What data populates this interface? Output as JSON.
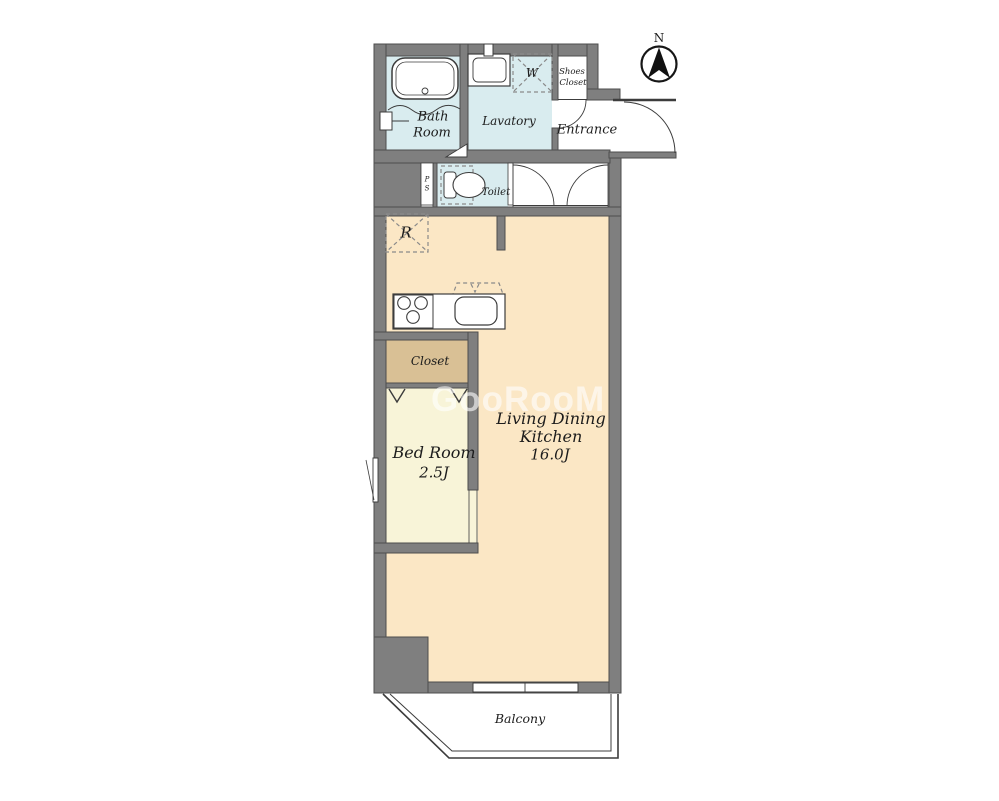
{
  "compass": {
    "label": "N"
  },
  "watermark": {
    "text": "GooRooM"
  },
  "rooms": {
    "bath": {
      "line1": "Bath",
      "line2": "Room"
    },
    "lavatory": {
      "label": "Lavatory"
    },
    "washer": {
      "label": "W"
    },
    "shoes_closet": {
      "line1": "Shoes",
      "line2": "Closet"
    },
    "entrance": {
      "label": "Entrance"
    },
    "pipe_space": {
      "line1": "P",
      "line2": "S"
    },
    "toilet": {
      "label": "Toilet"
    },
    "refrigerator": {
      "label": "R"
    },
    "closet": {
      "label": "Closet"
    },
    "bed_room": {
      "label": "Bed Room",
      "size": "2.5J"
    },
    "ldk": {
      "line1": "Living Dining",
      "line2": "Kitchen",
      "size": "16.0J"
    },
    "balcony": {
      "label": "Balcony"
    }
  },
  "colors": {
    "wall": "#7f7f7f",
    "ldk": "#fbe7c5",
    "bedroom": "#f8f4d8",
    "closet": "#d9c095",
    "wet": "#d9ecef",
    "floor_white": "#ffffff",
    "watermark": "rgba(255,255,255,0.6)"
  }
}
